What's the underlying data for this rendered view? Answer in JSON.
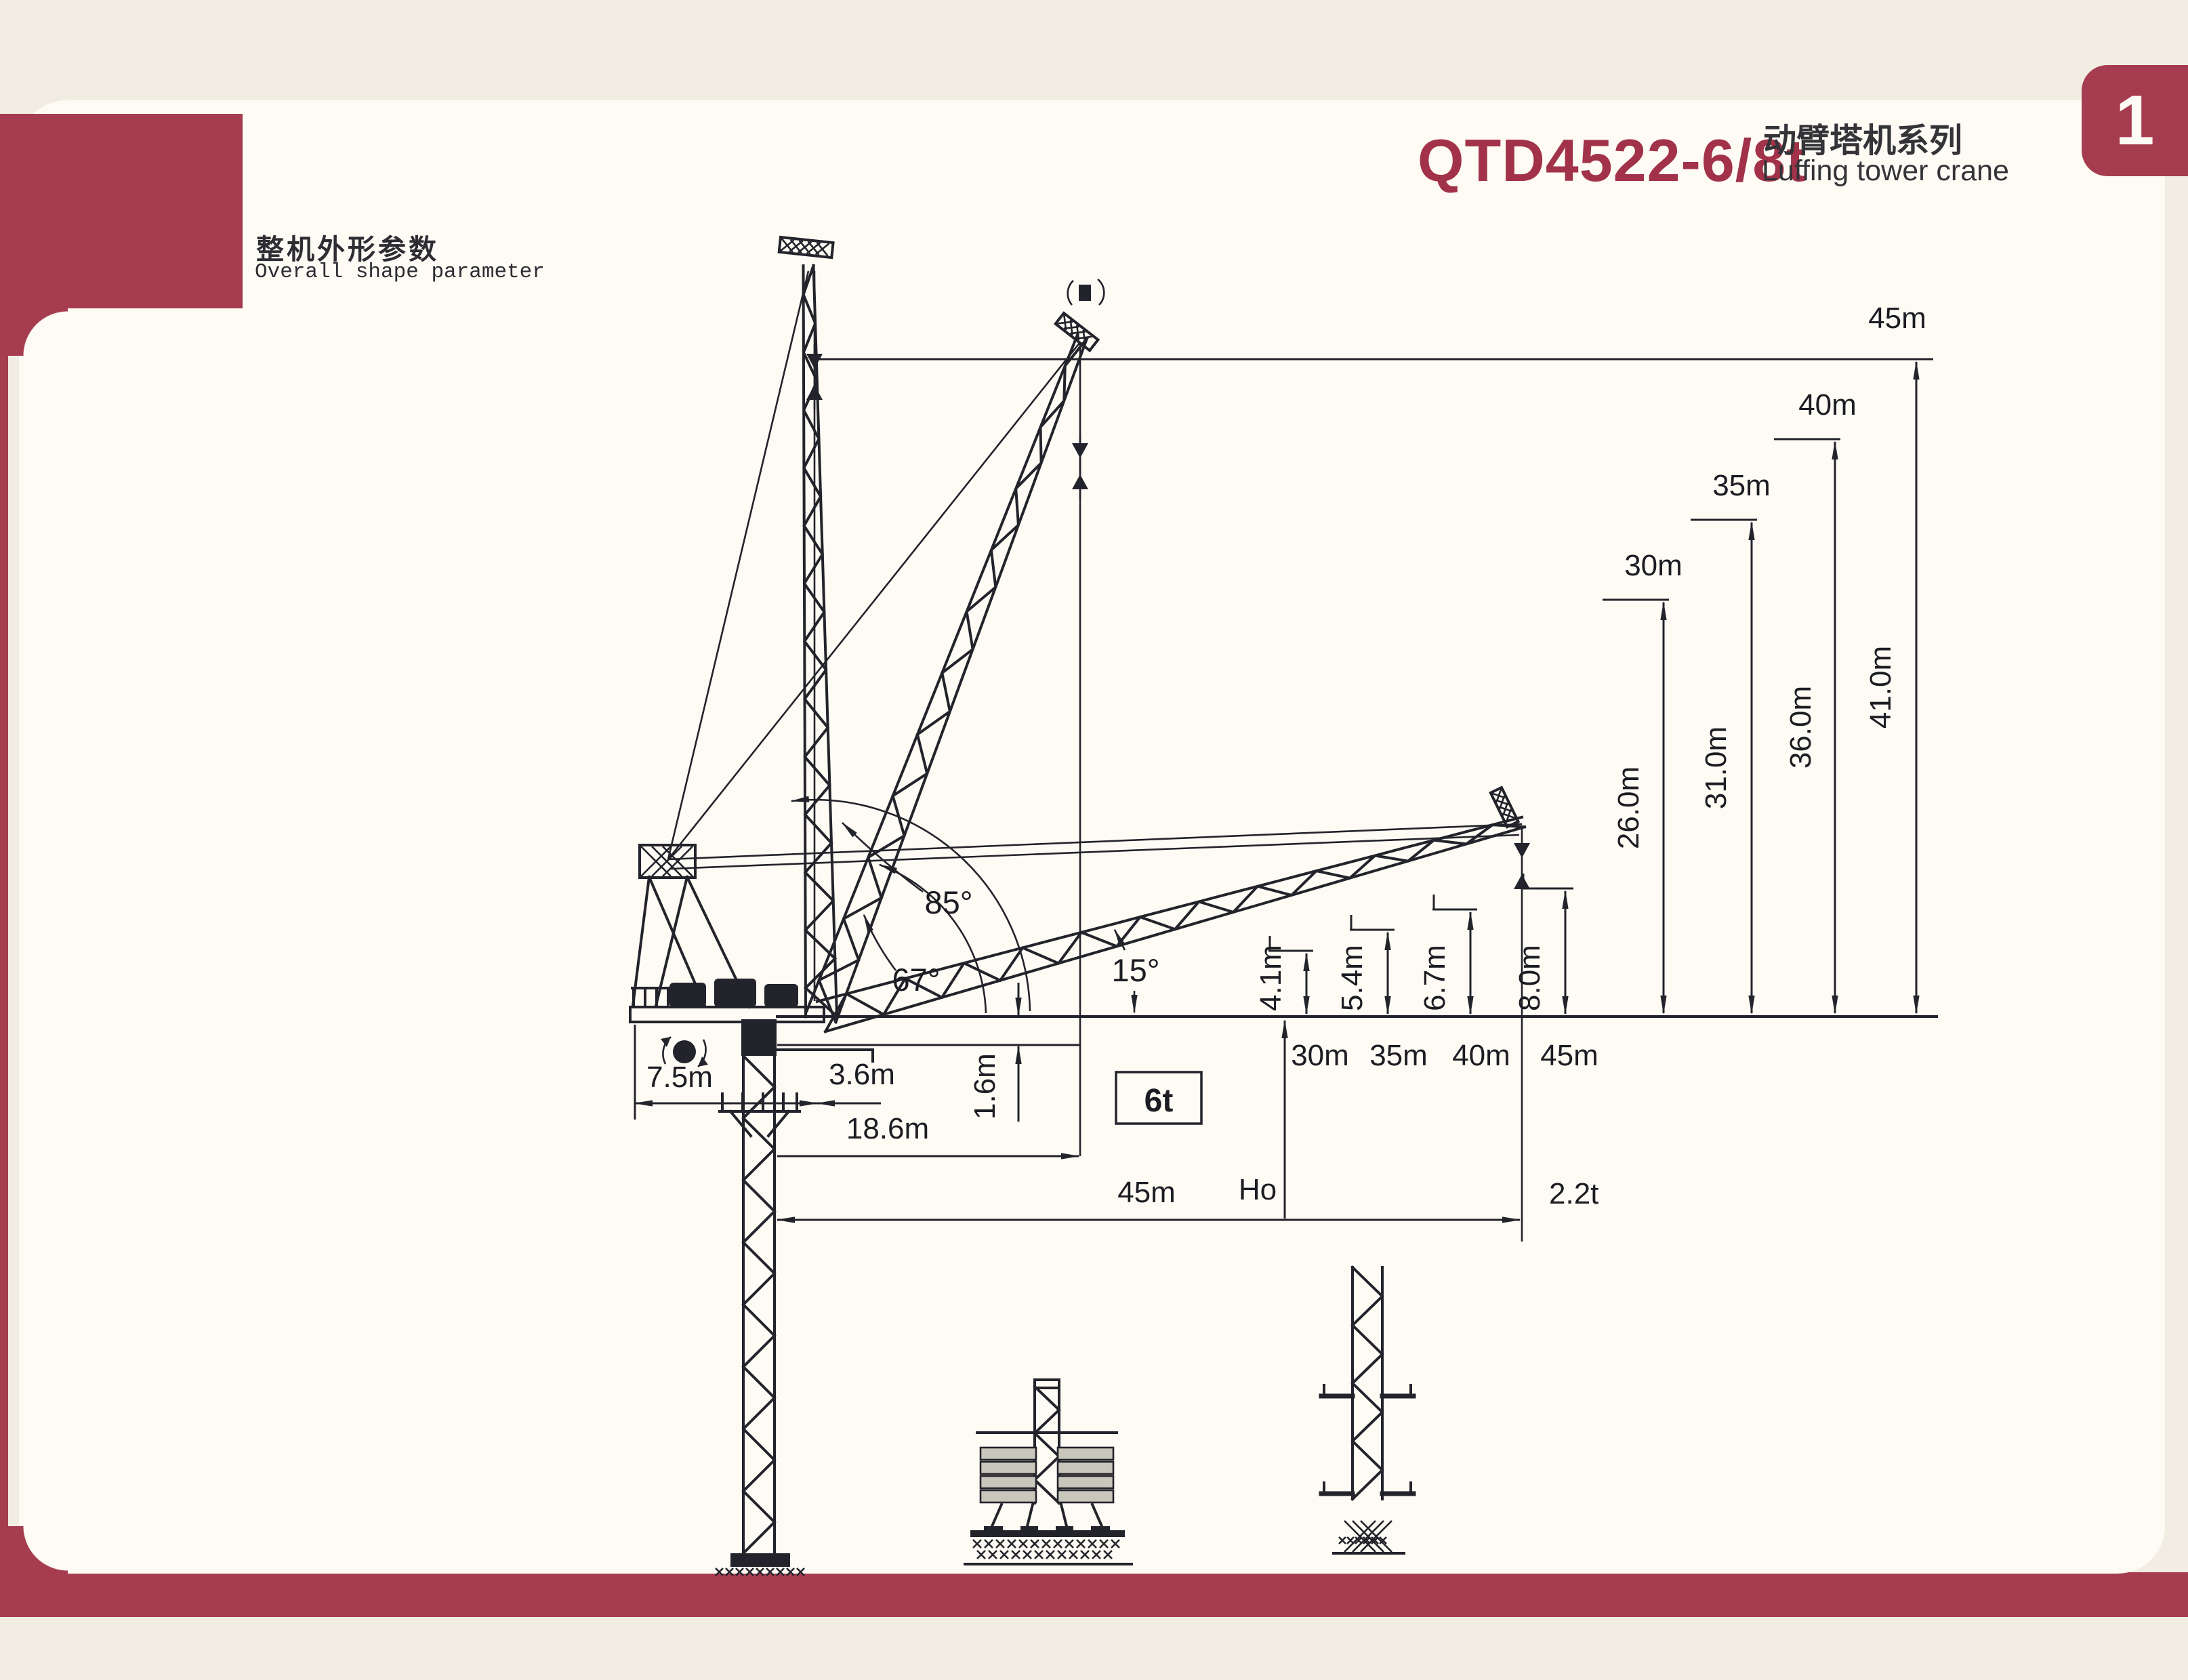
{
  "colors": {
    "accent": "#a63c50",
    "ink": "#23232b",
    "paper": "#fdfbf4",
    "background": "#f1ede2"
  },
  "header": {
    "model": "QTD4522-6/8t",
    "series_zh": "动臂塔机系列",
    "series_en": "Luffing tower crane",
    "page_number": "1"
  },
  "section": {
    "title_zh": "整机外形参数",
    "title_en": "Overall shape parameter"
  },
  "diagram": {
    "type": "crane-dimension-diagram",
    "configurations": [
      {
        "jib_length": "30m",
        "height_to_tip_line": "26.0m",
        "hook_clearance": "4.1m"
      },
      {
        "jib_length": "35m",
        "height_to_tip_line": "31.0m",
        "hook_clearance": "5.4m"
      },
      {
        "jib_length": "40m",
        "height_to_tip_line": "36.0m",
        "hook_clearance": "6.7m"
      },
      {
        "jib_length": "45m",
        "height_to_tip_line": "41.0m",
        "hook_clearance": "8.0m"
      }
    ],
    "angles": {
      "max": "85°",
      "mid": "67°",
      "min": "15°"
    },
    "counter_jib_radius": "7.5m",
    "slew_offset": "3.6m",
    "pivot_height": "1.6m",
    "min_radius": "18.6m",
    "max_radius": "45m",
    "hook_height_symbol": "Ho",
    "capacity_rated": "6t",
    "capacity_at_tip": "2.2t"
  }
}
